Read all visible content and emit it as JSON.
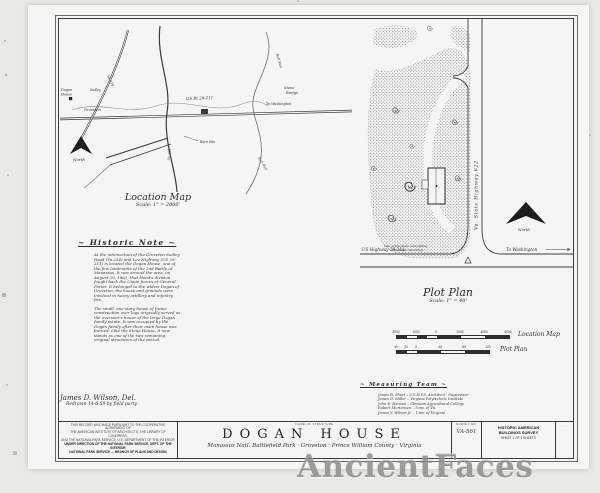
{
  "watermark": "AncientFaces",
  "location_map": {
    "title": "Location Map",
    "scale": "Scale: 1\" = 2000'",
    "north": "North",
    "labels": {
      "dogan1": "Dogan",
      "dogan2": "House",
      "groveton": "Groveton",
      "sudley": "Sudley",
      "va234": "Va 234",
      "va622": "Va 622",
      "us_rt": "US Rt 29-211",
      "stone1": "Stone",
      "stone2": "Bridge",
      "to_washington": "To Washington",
      "bull_run": "Bull Run",
      "barn": "Barn Site"
    }
  },
  "plot_plan": {
    "title": "Plot Plan",
    "scale": "Scale: 1\" = 40'",
    "north": "North",
    "hwy622": "Va. State Highway 622",
    "us_hwy": "US Highway 29-211",
    "to_washington": "To Washington",
    "note1": "Site of the stone outbuilding",
    "note2": "(no longer standing)"
  },
  "historic_note": {
    "heading": "~ Historic Note ~",
    "para1": "At the intersection of the Groveton-Sudley Road (Va 234) and Lee Highway (US 29-211) is located the Dogan House, one of the few landmarks of the 2nd Battle of Manassas. It was around the area, on August 29, 1862, that Hood's division fought back the Union forces of General Porter. It belonged to the widow Dogan of Groveton; the house and grounds were involved in heavy artillery and infantry fire.",
    "para2": "The small, one-story house of frame construction over logs originally served as the overseer's house of the large Dogan family estate. It was occupied by the Dogan family after their main house was burned. Like the Stone House, it now stands as one of the two remaining original structures of the period."
  },
  "signature": {
    "line1": "James D. Wilson, Del.",
    "line2": "Redrawn 14-6-59 by field party"
  },
  "scale_bars": {
    "loc": {
      "ticks": [
        "2000",
        "1000",
        "0",
        "2000",
        "4000",
        "6000"
      ],
      "label": "Location Map"
    },
    "plot": {
      "ticks": [
        "40",
        "20",
        "0",
        "40",
        "80",
        "120"
      ],
      "label": "Plot Plan"
    }
  },
  "measuring_team": {
    "heading": "~ Measuring Team ~",
    "members": [
      "James R. Short – U.S.N.P.S. Architect : Supervisor",
      "James D. Miller – Virginia Polytechnic Institute",
      "John E. Hansen – Clemson Agricultural College",
      "Robert Mortensen – Univ. of Va.",
      "James Y. Wilson Jr. – Univ. of Virginia"
    ]
  },
  "title_block": {
    "legal": [
      "THIS RECORD WAS MADE PURSUANT TO THE COOPERATIVE AGREEMENT OF",
      "THE AMERICAN INSTITUTE OF ARCHITECTS, THE LIBRARY OF CONGRESS,",
      "AND THE NATIONAL PARK SERVICE, U.S. DEPARTMENT OF THE INTERIOR",
      "UNDER DIRECTION OF THE NATIONAL PARK SERVICE, DEPT. OF THE INTERIOR",
      "NATIONAL PARK SERVICE — BRANCH OF PLANS AND DESIGN"
    ],
    "name_label": "NAME OF STRUCTURE",
    "title": "DOGAN HOUSE",
    "subtitle": "Manassas Natl. Battlefield Park · Groveton · Prince William County · Virginia",
    "survey_label": "SURVEY NO.",
    "survey_no": "VA-561",
    "habs1": "HISTORIC AMERICAN",
    "habs2": "BUILDINGS SURVEY",
    "sheet": "SHEET 1 OF 3 SHEETS",
    "corner1": "· · · · ·",
    "corner2": "· · ·"
  }
}
